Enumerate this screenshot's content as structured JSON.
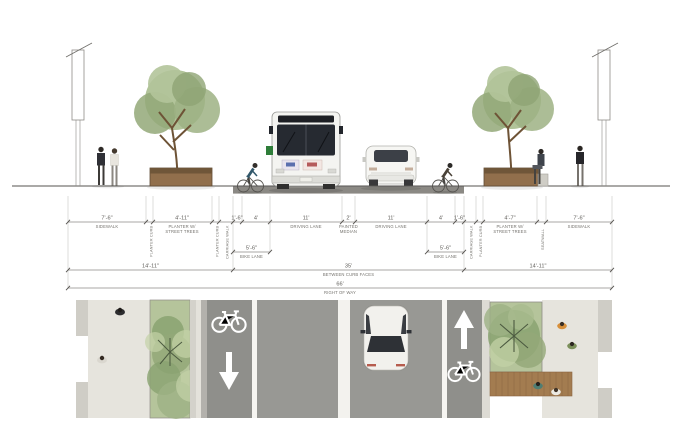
{
  "diagram": {
    "type": "street-cross-section",
    "views": {
      "top": "section-elevation",
      "bottom": "plan-view"
    }
  },
  "palette": {
    "foliage": "#9db284",
    "asphalt": "#989894",
    "bike_lane": "#8f8f8b",
    "concrete": "#e6e4dd",
    "planting": "#b5c49b",
    "wood_deck": "#a37c50",
    "marking_white": "#ffffff",
    "dim_line": "#8d8b87",
    "dim_text": "#5f5d59"
  },
  "dims": {
    "row1": [
      {
        "v": "7'-6\"",
        "l1": "SIDEWALK"
      },
      {
        "v": "4'-11\"",
        "l1": "PLANTER W/",
        "l2": "STREET TREES"
      },
      {
        "v": "1'-6\""
      },
      {
        "v": "4'"
      },
      {
        "v": "11'",
        "l1": "DRIVING LANE"
      },
      {
        "v": "2'",
        "l1": "PAINTED",
        "l2": "MEDIAN"
      },
      {
        "v": "11'",
        "l1": "DRIVING LANE"
      },
      {
        "v": "4'"
      },
      {
        "v": "1'-6\""
      },
      {
        "v": "4'-7\"",
        "l1": "PLANTER W/",
        "l2": "STREET TREES"
      },
      {
        "v": "7'-6\"",
        "l1": "SIDEWALK"
      }
    ],
    "vertical_labels": [
      "PLANTER CURB",
      "PLANTER CURB",
      "CARRIAGE WALK",
      "CARRIAGE WALK",
      "PLANTER CURB",
      "SEATWALL"
    ],
    "bike_left": {
      "v": "5'-6\"",
      "l": "BIKE LANE"
    },
    "bike_right": {
      "v": "5'-6\"",
      "l": "BIKE LANE"
    },
    "row3": [
      {
        "v": "14'-11\""
      },
      {
        "v": "35'",
        "l": "BETWEEN CURB FACES"
      },
      {
        "v": "14'-11\""
      }
    ],
    "row4": {
      "v": "66'",
      "l": "RIGHT OF WAY"
    }
  },
  "plan": {
    "markings": {
      "left_bike_lane": [
        "bike-icon",
        "down-arrow-icon"
      ],
      "right_bike_lane": [
        "up-arrow-icon",
        "bike-icon"
      ]
    }
  }
}
